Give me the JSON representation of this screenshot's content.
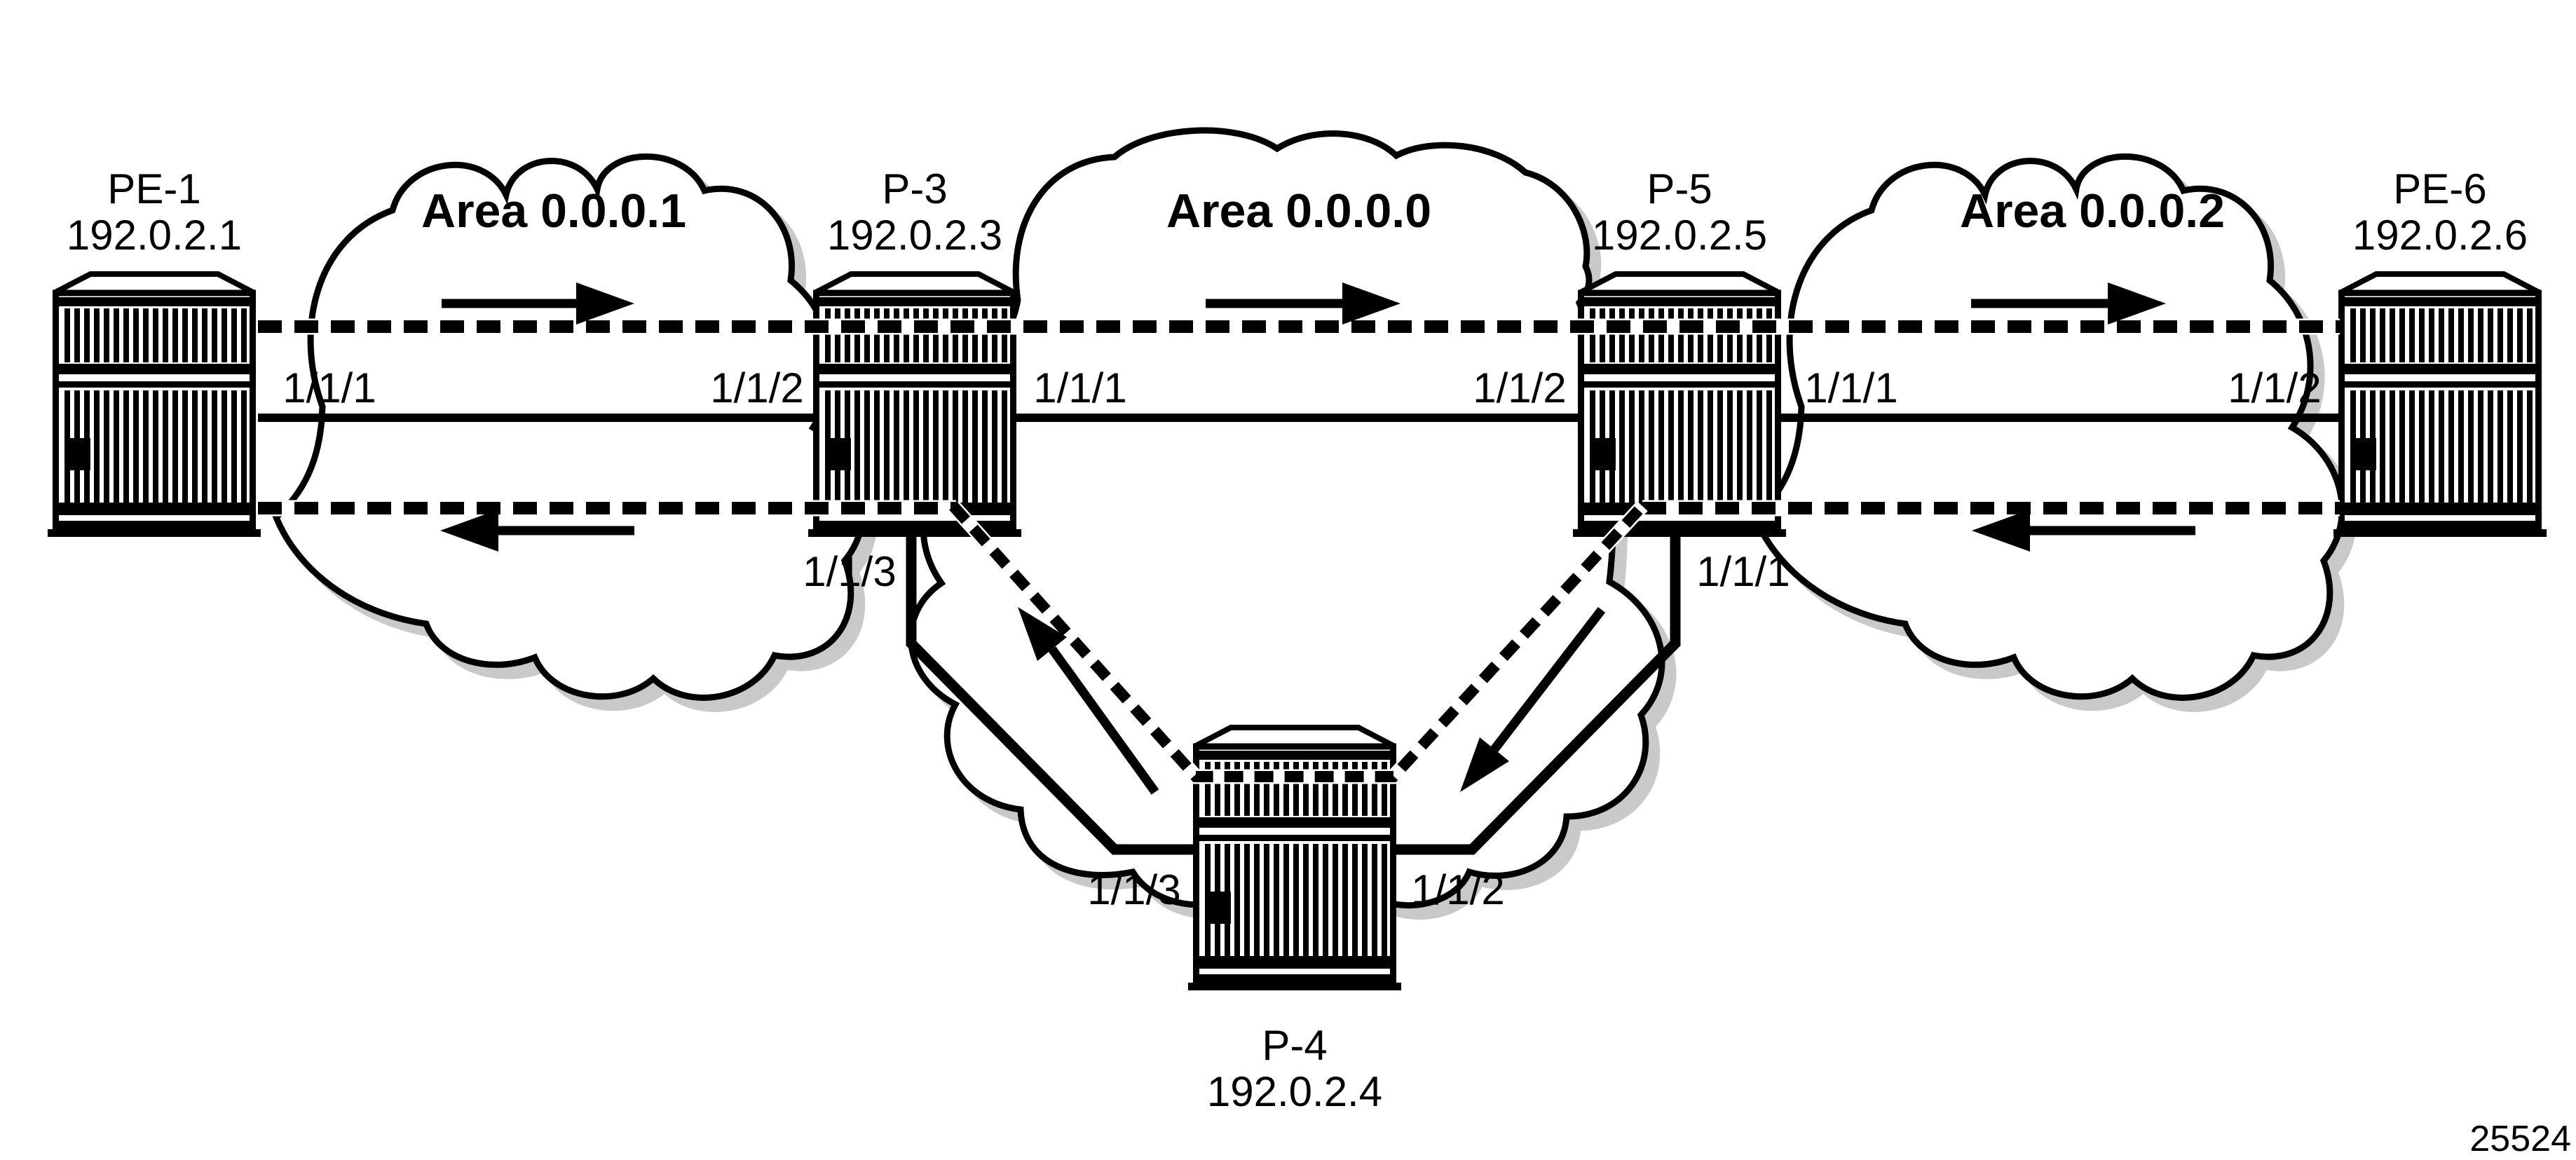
{
  "diagram": {
    "type": "ospf-network-topology",
    "figure_number": "25524",
    "colors": {
      "ink": "#000000",
      "cloud_shadow": "#c9c9c9",
      "background": "#ffffff"
    },
    "areas": [
      {
        "id": "area-1",
        "label": "Area 0.0.0.1"
      },
      {
        "id": "area-0",
        "label": "Area 0.0.0.0"
      },
      {
        "id": "area-2",
        "label": "Area 0.0.0.2"
      }
    ],
    "routers": [
      {
        "name": "PE-1",
        "ip": "192.0.2.1"
      },
      {
        "name": "P-3",
        "ip": "192.0.2.3"
      },
      {
        "name": "P-5",
        "ip": "192.0.2.5"
      },
      {
        "name": "PE-6",
        "ip": "192.0.2.6"
      },
      {
        "name": "P-4",
        "ip": "192.0.2.4"
      }
    ],
    "interfaces": {
      "pe1_p3": {
        "left": "1/1/1",
        "right": "1/1/2"
      },
      "p3_p5": {
        "left": "1/1/1",
        "right": "1/1/2"
      },
      "p5_pe6": {
        "left": "1/1/1",
        "right": "1/1/2"
      },
      "p3_p4": {
        "p3_side": "1/1/3",
        "p4_side": "1/1/3"
      },
      "p5_p4": {
        "p5_side": "1/1/1",
        "p4_side": "1/1/2"
      }
    },
    "traffic_flow": {
      "upper_path_direction": "left-to-right",
      "lower_path_direction": "right-to-left"
    }
  }
}
